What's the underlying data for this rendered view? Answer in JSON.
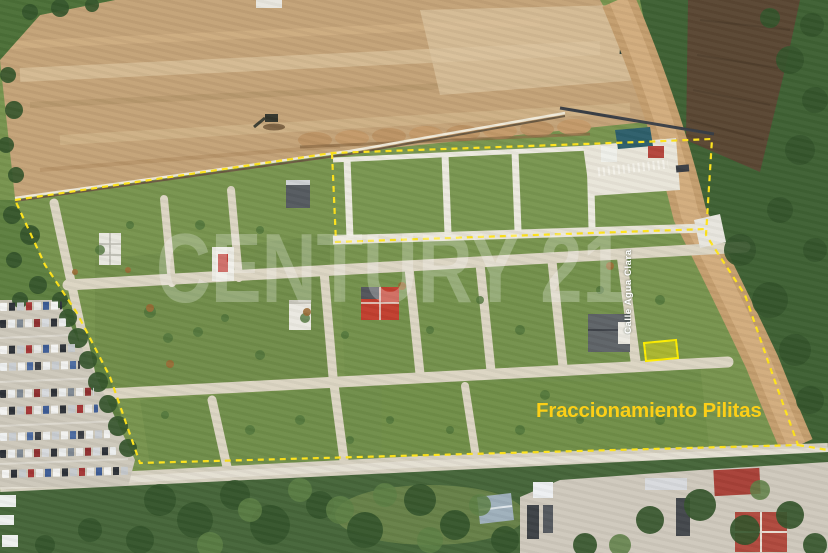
{
  "image": {
    "description_label": "aerial-photo-of-land-development",
    "labels": {
      "development_name": "Fraccionamiento Pilitas",
      "street_name": "Calle Agua Clara",
      "watermark": "CENTURY 21"
    },
    "colors": {
      "boundary_yellow": "#ffe41c",
      "development_label_yellow": "#fccf17",
      "street_label_white": "#ffffff",
      "watermark_white": "rgba(255,255,255,0.25)",
      "highlight_lot_fill": "rgba(255,238,0,0.38)",
      "highlight_lot_stroke": "#ffee00"
    }
  }
}
